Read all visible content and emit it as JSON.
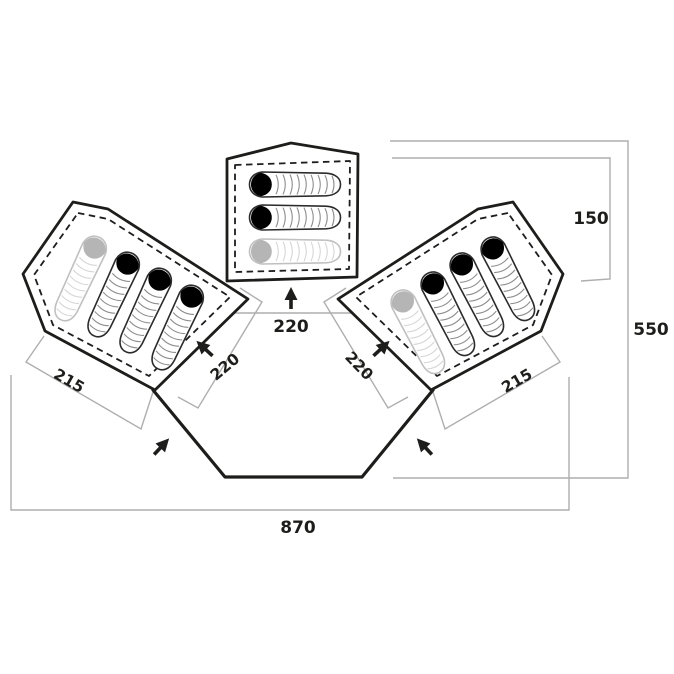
{
  "diagram": {
    "description_labels": {
      "total_width": "870",
      "total_depth": "550",
      "center_cabin_depth": "150",
      "center_cabin_entrance_width": "220",
      "left_cabin_entrance_width": "220",
      "right_cabin_entrance_width": "220",
      "left_cabin_depth": "215",
      "right_cabin_depth": "215"
    },
    "sleeping_bags": {
      "center_cabin": 3,
      "left_cabin": 4,
      "right_cabin": 4,
      "faded_per_cabin": 1
    },
    "colors": {
      "outline": "#1d1d1b",
      "dimension_line": "#aeaeae",
      "bag_hood": "#000000",
      "faded_bag": "#b5b5b5",
      "background": "#ffffff"
    }
  }
}
